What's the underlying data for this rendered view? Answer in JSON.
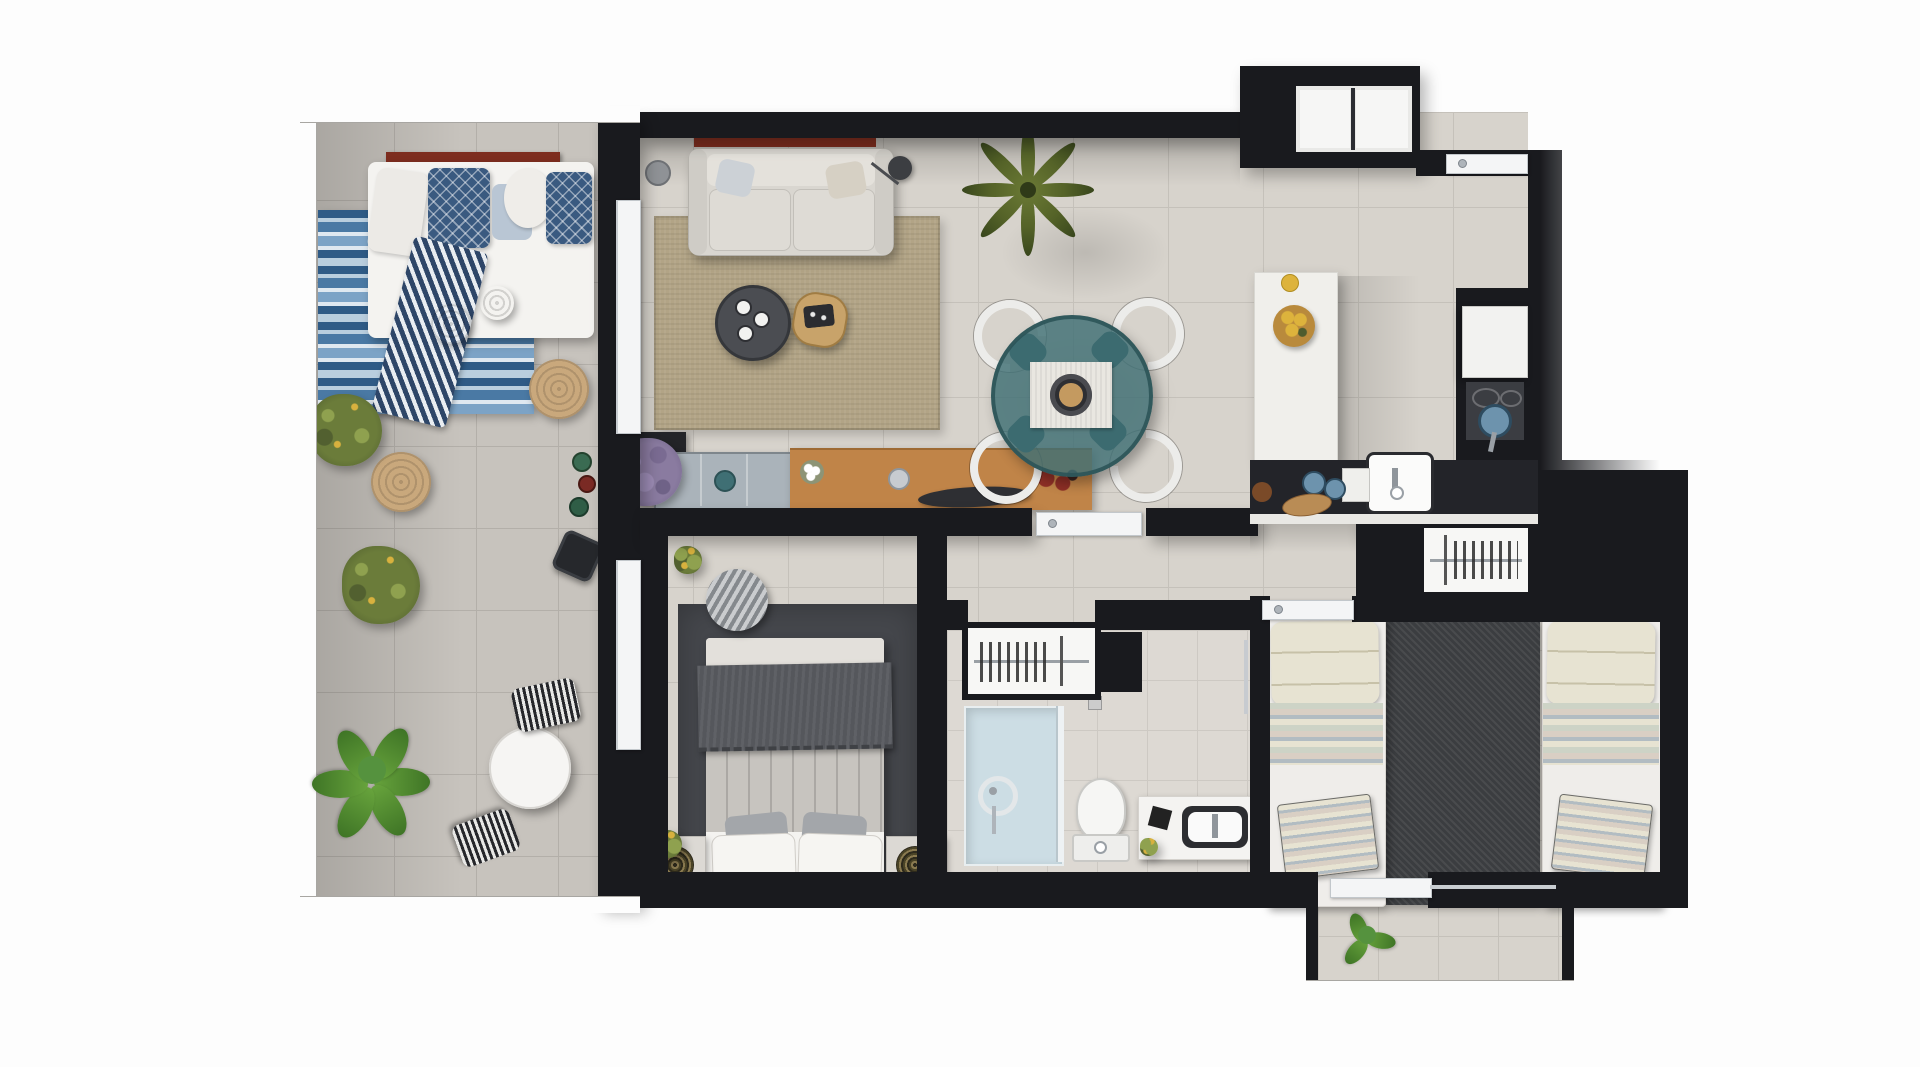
{
  "scene": {
    "kind": "3d-rendered apartment floor plan, top-down view",
    "visible_text": "",
    "rooms": [
      {
        "id": "terrace",
        "name": "Terrace"
      },
      {
        "id": "living-room",
        "name": "Living room"
      },
      {
        "id": "dining-area",
        "name": "Dining area"
      },
      {
        "id": "kitchen",
        "name": "Kitchen"
      },
      {
        "id": "hallway",
        "name": "Hallway"
      },
      {
        "id": "master-bedroom",
        "name": "Master bedroom"
      },
      {
        "id": "bathroom",
        "name": "Bathroom"
      },
      {
        "id": "second-bedroom",
        "name": "Second bedroom"
      },
      {
        "id": "balcony",
        "name": "Balcony"
      }
    ]
  },
  "palette": {
    "page": "#fdfdfd",
    "wall": "#191a1e",
    "wallSoft": "#2b2d32",
    "floor": "#d7d3cc",
    "floorLine": "#c5c1ba",
    "terrace": "#c7c3bd",
    "terraceLine": "#b3afa9",
    "bathFloor": "#ddd9d3",
    "white": "#f4f3f0",
    "offWhite": "#e9e7e1",
    "sofa": "#d9d6d0",
    "sofaCush": "#e4e1db",
    "gray": "#a3a6aa",
    "darkGray": "#55575c",
    "rugSisal": "#b2a486",
    "rugDark": "#45474c",
    "rugCharcoal": "#3b3d40",
    "blue1": "#2f5b86",
    "blue2": "#7ca3c6",
    "blue3": "#dfe8f0",
    "blue4": "#4a79a4",
    "blue5": "#b9cede",
    "navy": "#3a5a80",
    "teal": "#3f6f74",
    "tealDark": "#2f585e",
    "tealGlass": "rgba(63,111,116,0.82)",
    "wood": "#c08448",
    "woodRed": "#7d2d1f",
    "tan": "#d9b98c",
    "jute": "#c9a87c",
    "green": "#55923e",
    "greenDark": "#3f7526",
    "olive": "#6b7c3a",
    "palmG": "#556328",
    "lavender": "#8a7ba0",
    "lemon": "#ddb33c",
    "bowlWood": "#b98a3c",
    "steel": "#c7cbd0",
    "panBlue": "#6d93ad",
    "shower": "#ccdde4",
    "glass": "#eef2f4",
    "counter": "#232429",
    "stove": "#3b3d42",
    "duvet": "#c7c4bf",
    "cream": "#e7e3d2",
    "pastel1": "#cdd3c6",
    "pastel2": "#d9cfc4",
    "pastel3": "#b2bcc2"
  },
  "furniture": {
    "terrace": [
      "daybed",
      "wooden-daybed-rail",
      "navy-diamond-pillows",
      "striped-navy-throw",
      "blue-striped-rug",
      "rattan-pouf",
      "rattan-pouf",
      "jute-pouf",
      "jute-pouf",
      "olive-plant",
      "olive-plant",
      "large-leafy-plant",
      "round-bistro-table",
      "striped-chair",
      "striped-chair",
      "decor-bottles",
      "hexagonal-side-table"
    ],
    "living_room": [
      "two-seat-sofa",
      "scatter-pillows",
      "timber-wall-rail",
      "floor-lamp",
      "ceramic-vase",
      "sisal-rug",
      "round-coffee-table-with-cups",
      "timber-side-table-with-tray",
      "potted-palm"
    ],
    "dining_area": [
      "round-glass-dining-table",
      "table-runner",
      "serving-bowl",
      "dining-chair",
      "dining-chair",
      "dining-chair",
      "dining-chair"
    ],
    "sideboard_zone": [
      "glass-display-cabinet",
      "teal-bowl",
      "timber-sideboard",
      "lavender-plant",
      "flower-vase",
      "metal-cup",
      "serving-platter",
      "red-decor-object"
    ],
    "kitchen": [
      "island-counter",
      "fruit-bowl-with-lemons",
      "single-lemon",
      "kitchen-counter",
      "sink-with-tap",
      "small-appliance",
      "storage-jars",
      "cutting-boards",
      "wood-decor",
      "refrigerator",
      "cooktop-with-pan",
      "window-two-panes",
      "entrance-door"
    ],
    "hallway": [
      "master-bedroom-door",
      "second-bedroom-door",
      "built-in-wardrobe-with-hangers"
    ],
    "master_bedroom": [
      "double-bed",
      "striped-duvet",
      "dark-throw-blanket",
      "white-pillows",
      "gray-pillows",
      "nightstand",
      "nightstand",
      "mandala-decor",
      "mandala-decor",
      "striped-pouf",
      "potted-plant",
      "potted-plant",
      "dark-area-rug",
      "terrace-sliding-door"
    ],
    "bathroom": [
      "wardrobe-with-hangers",
      "storage-bench",
      "walk-in-shower",
      "shower-head",
      "glass-screen",
      "toilet",
      "vanity-with-basin",
      "tap",
      "towel-rail",
      "decor-box",
      "plant-sprig"
    ],
    "second_bedroom": [
      "single-bed",
      "single-bed",
      "striped-pillows",
      "pastel-striped-blankets",
      "striped-bench-cushion",
      "striped-bench-cushion",
      "charcoal-rug",
      "built-in-wardrobe-with-hangers"
    ],
    "balcony": [
      "potted-plant",
      "glass-balustrade",
      "sliding-door"
    ]
  },
  "counts": {
    "windows": 1,
    "doors": 6,
    "rooms": 9,
    "beds": 4,
    "plants": 9
  }
}
